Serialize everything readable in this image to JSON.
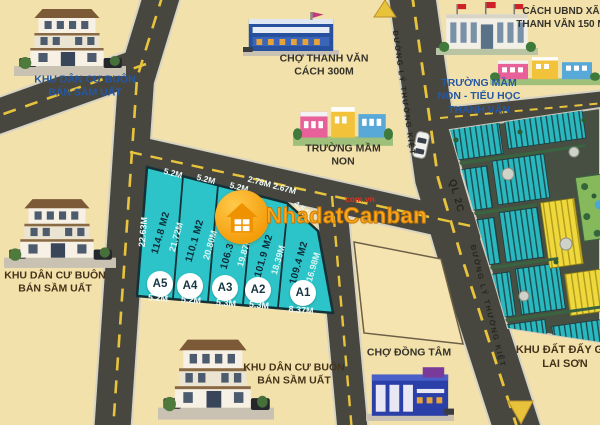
{
  "brand": {
    "name": "NhadatCanban",
    "domain": "com.vn"
  },
  "plots": {
    "left_edge_length": "22.63M",
    "items": [
      {
        "id": "A5",
        "area": "114.8 M2",
        "side": "21.72M",
        "top_width": "5.2M",
        "bottom_width": "5.2M"
      },
      {
        "id": "A4",
        "area": "110.1 M2",
        "side": "20.80M",
        "top_width": "5.2M",
        "bottom_width": "5.2M"
      },
      {
        "id": "A3",
        "area": "106.3 M2",
        "side": "19.87M",
        "top_width": "5.2M",
        "bottom_width": "5.3M"
      },
      {
        "id": "A2",
        "area": "101.9 M2",
        "side": "18.39M",
        "top_width": "2.78M 2.67M",
        "bottom_width": "5.3M"
      },
      {
        "id": "A1",
        "area": "109.4 M2",
        "side": "16.98M",
        "top_width": "4.54M",
        "bottom_width": "8.37M"
      }
    ]
  },
  "roads": {
    "ly_thuong_kiet_top": "ĐƯỜNG LÝ THƯỜNG KIỆT",
    "ql_2c": "QL 2C",
    "ly_thuong_kiet_bottom": "ĐƯỜNG LÝ THƯỜNG KIỆT"
  },
  "landmarks": {
    "residential_top_left": {
      "line1": "KHU DÂN CƯ BUÔN",
      "line2": "BÁN SẦM UẤT"
    },
    "cho_thanh_van": {
      "line1": "CHỢ THANH VĂN",
      "line2": "CÁCH 300M"
    },
    "ubnd_xa": {
      "line1": "CÁCH UBND XÃ",
      "line2": "THANH VĂN 150 M"
    },
    "truong_thanh_van": {
      "line1": "TRƯỜNG MẦM",
      "line2": "NON - TIỂU HỌC",
      "line3": "THANH VĂN"
    },
    "truong_mam_non": {
      "line1": "TRƯỜNG MẦM",
      "line2": "NON"
    },
    "residential_left": {
      "line1": "KHU DÂN CƯ BUÔN",
      "line2": "BÁN SẦM UẤT"
    },
    "residential_bottom": {
      "line1": "KHU DÂN CƯ BUÔN",
      "line2": "BÁN SẦM UẤT"
    },
    "cho_dong_tam": {
      "label": "CHỢ ĐỒNG TÂM"
    },
    "khu_dat_lai_son": {
      "line1": "KHU ĐẤT ĐẤY GIÁ",
      "line2": "LAI SƠN"
    }
  },
  "icons": {
    "logo": "house-icon",
    "direction_up": "arrow-up-icon",
    "direction_down": "arrow-down-icon",
    "vehicle": "car-icon"
  },
  "colors": {
    "background": "#f3e1ab",
    "road": "#474740",
    "road_dash": "#e8c43c",
    "plot_fill": "#2cc4c8",
    "plot_border": "#153138",
    "brand_orange": "#f8a81c",
    "brand_domain_red": "#e0301e",
    "label_blue": "#2457a6",
    "label_brown": "#45321a",
    "plan_teal": "#29b8be",
    "plan_yellow": "#eed83c"
  }
}
